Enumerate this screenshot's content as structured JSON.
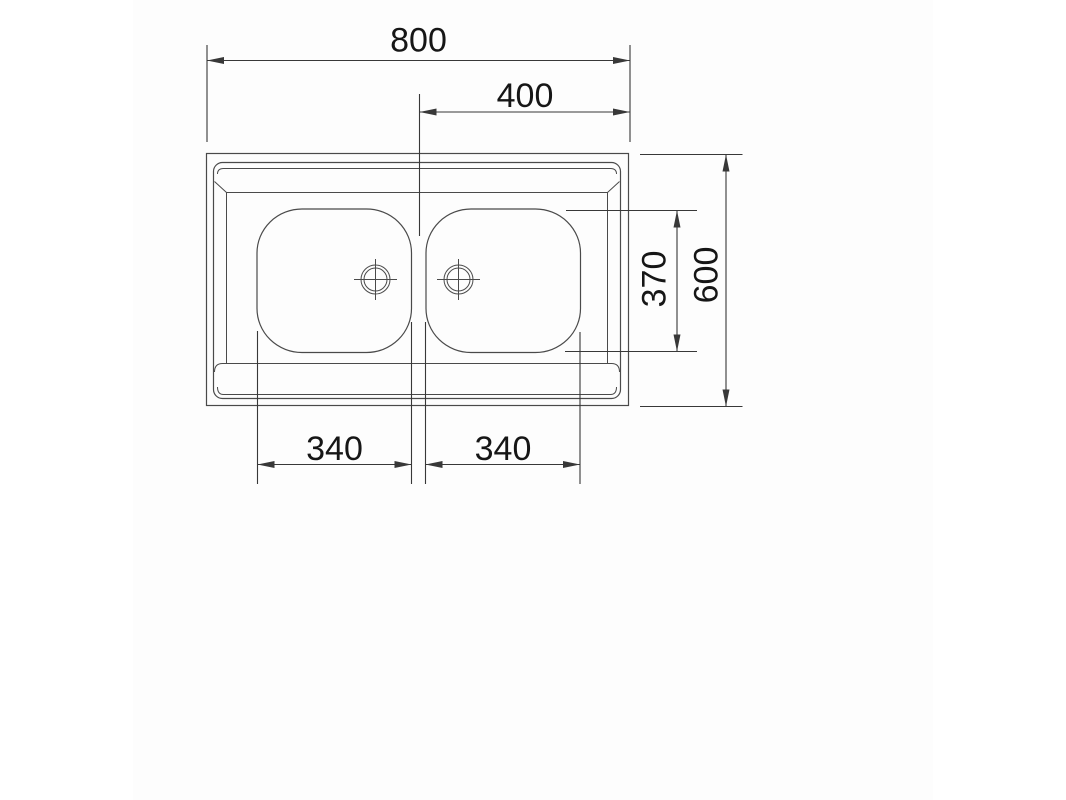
{
  "theme": {
    "background": "#ffffff",
    "canvas_background": "#fdfdfd",
    "line_color": "#4a4a4a",
    "dimension_line_color": "#383838",
    "text_color": "#161616"
  },
  "drawing": {
    "type": "technical-dimension-drawing",
    "subject": "double-bowl sink, top view",
    "dimensions": {
      "overall_width": "800",
      "right_half_width": "400",
      "overall_depth": "600",
      "bowl_depth": "370",
      "left_bowl_width": "340",
      "right_bowl_width": "340"
    }
  }
}
